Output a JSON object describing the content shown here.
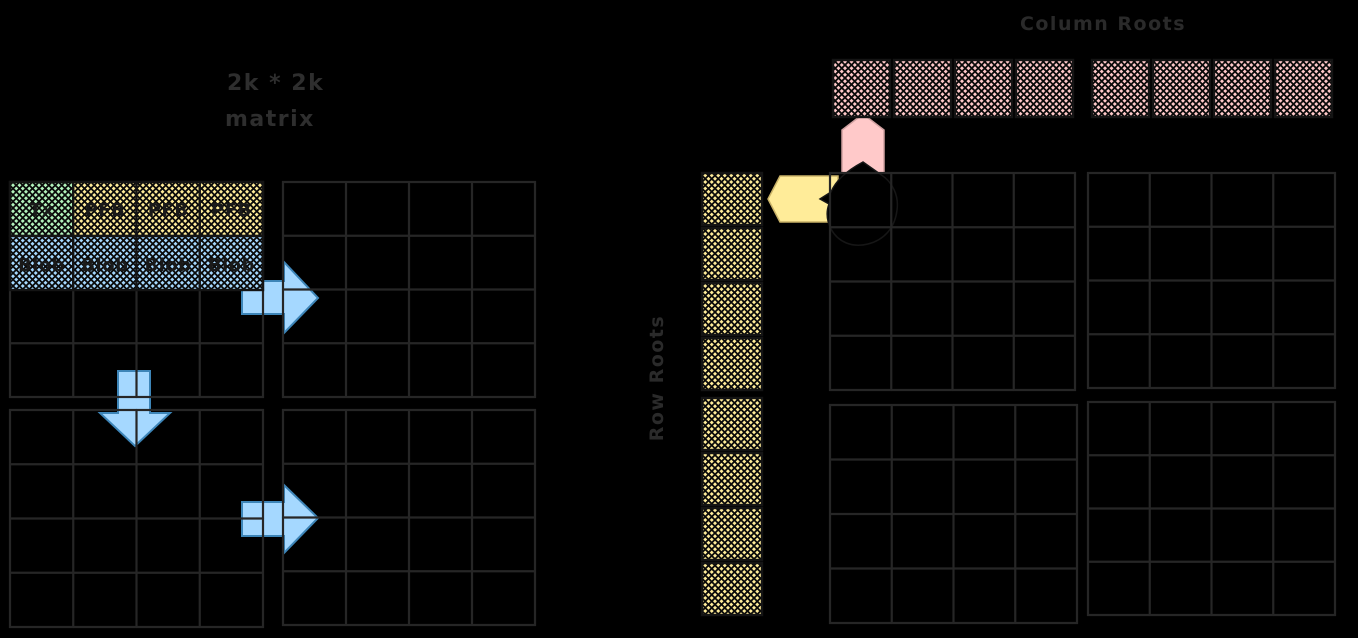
{
  "title": {
    "line1": "2k * 2k",
    "line2": "matrix"
  },
  "matrix": {
    "header_row": [
      {
        "label": "Tx",
        "color": "#b2f2bb"
      },
      {
        "label": "PFB",
        "color": "#ffec99"
      },
      {
        "label": "PFB",
        "color": "#ffec99"
      },
      {
        "label": "PFB",
        "color": "#ffec99"
      }
    ],
    "blob_row": [
      {
        "label": "Blob",
        "color": "#a5d8ff"
      },
      {
        "label": "Blob",
        "color": "#a5d8ff"
      },
      {
        "label": "Blob",
        "color": "#a5d8ff"
      },
      {
        "label": "Blob",
        "color": "#a5d8ff"
      }
    ]
  },
  "column_roots": {
    "label": "Column Roots",
    "color": "#ffc9c9",
    "cell_count": 8
  },
  "row_roots": {
    "label": "Row Roots",
    "color": "#ffec99",
    "cell_count": 8
  },
  "arrows": {
    "color": "#a5d8ff"
  },
  "colors": {
    "background": "#000000",
    "grid_stroke": "#262626",
    "ink": "#2e2e2e",
    "cell_border": "#141414",
    "pink": "#ffc9c9",
    "yellow": "#ffec99",
    "green": "#b2f2bb",
    "blue": "#a5d8ff"
  }
}
